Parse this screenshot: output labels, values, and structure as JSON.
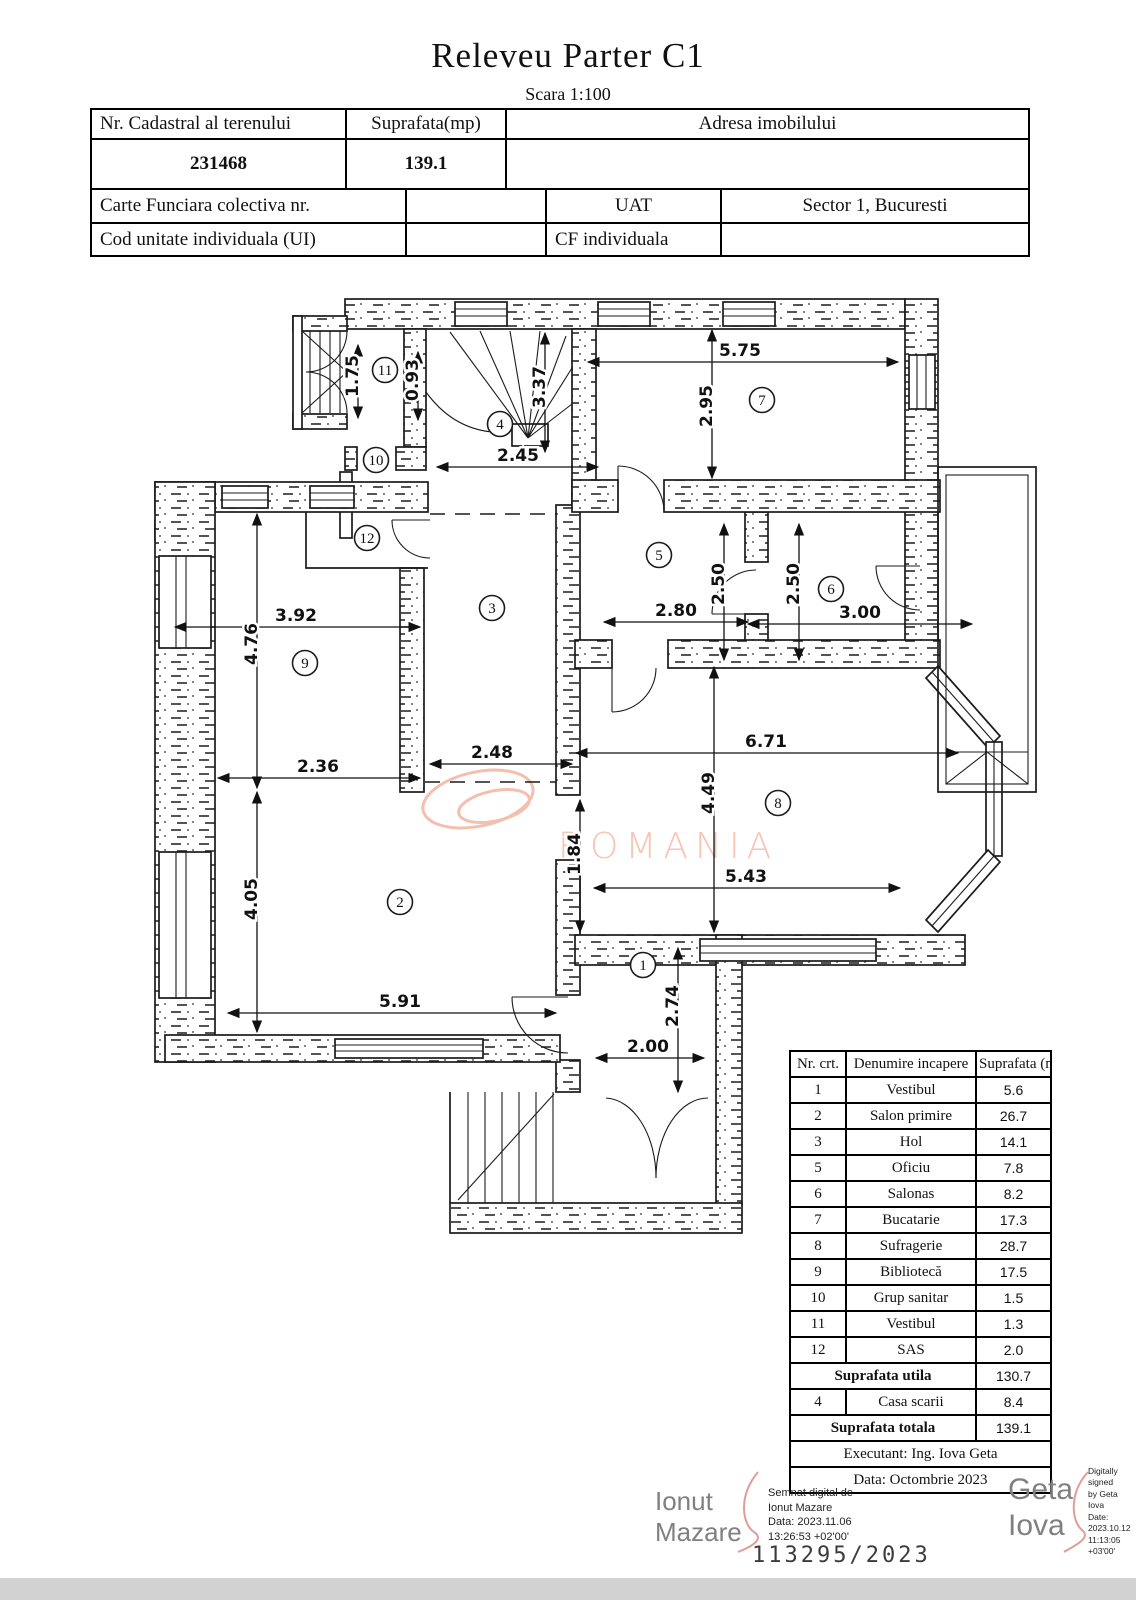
{
  "title": "Releveu Parter C1",
  "subtitle": "Scara 1:100",
  "header_table": {
    "nr_cadastral_label": "Nr. Cadastral al terenului",
    "nr_cadastral_value": "231468",
    "suprafata_label": "Suprafata(mp)",
    "suprafata_value": "139.1",
    "adresa_label": "Adresa imobilului",
    "adresa_value": "",
    "carte_funciara_label": "Carte Funciara colectiva nr.",
    "carte_funciara_value": "",
    "uat_label": "UAT",
    "uat_value": "Sector 1, Bucuresti",
    "cod_unitate_label": "Cod unitate individuala (UI)",
    "cod_unitate_value": "",
    "cf_individuala_label": "CF individuala",
    "cf_individuala_value": ""
  },
  "plan": {
    "watermark": "ROMANIA",
    "watermark_color": "#f6c5b4",
    "rooms": [
      "1",
      "2",
      "3",
      "4",
      "5",
      "6",
      "7",
      "8",
      "9",
      "10",
      "11",
      "12"
    ],
    "dims": [
      "1.75",
      "0.93",
      "3.37",
      "2.45",
      "5.75",
      "2.95",
      "2.50",
      "2.50",
      "3.00",
      "2.80",
      "3.92",
      "4.76",
      "2.36",
      "2.48",
      "6.71",
      "4.49",
      "1.84",
      "5.43",
      "4.05",
      "5.91",
      "2.00",
      "2.74"
    ]
  },
  "room_table": {
    "headers": [
      "Nr. crt.",
      "Denumire incapere",
      "Suprafata (mp)"
    ],
    "rows": [
      {
        "nr": "1",
        "name": "Vestibul",
        "area": "5.6"
      },
      {
        "nr": "2",
        "name": "Salon primire",
        "area": "26.7"
      },
      {
        "nr": "3",
        "name": "Hol",
        "area": "14.1"
      },
      {
        "nr": "5",
        "name": "Oficiu",
        "area": "7.8"
      },
      {
        "nr": "6",
        "name": "Salonas",
        "area": "8.2"
      },
      {
        "nr": "7",
        "name": "Bucatarie",
        "area": "17.3"
      },
      {
        "nr": "8",
        "name": "Sufragerie",
        "area": "28.7"
      },
      {
        "nr": "9",
        "name": "Bibliotecă",
        "area": "17.5"
      },
      {
        "nr": "10",
        "name": "Grup sanitar",
        "area": "1.5"
      },
      {
        "nr": "11",
        "name": "Vestibul",
        "area": "1.3"
      },
      {
        "nr": "12",
        "name": "SAS",
        "area": "2.0"
      }
    ],
    "suprafata_utila_label": "Suprafata utila",
    "suprafata_utila_value": "130.7",
    "casa_scarii": {
      "nr": "4",
      "name": "Casa scarii",
      "area": "8.4"
    },
    "suprafata_totala_label": "Suprafata totala",
    "suprafata_totala_value": "139.1",
    "executant": "Executant: Ing. Iova Geta",
    "data": "Data: Octombrie 2023"
  },
  "signatures": {
    "left_name_line1": "Ionut",
    "left_name_line2": "Mazare",
    "left_details": [
      "Semnat digital de",
      "Ionut Mazare",
      "Data: 2023.11.06",
      "13:26:53 +02'00'"
    ],
    "case_number": "113295/2023",
    "right_name_line1": "Geta",
    "right_name_line2": "Iova",
    "right_details": [
      "Digitally signed",
      "by Geta Iova",
      "Date:",
      "2023.10.12",
      "11:13:05",
      "+03'00'"
    ]
  }
}
